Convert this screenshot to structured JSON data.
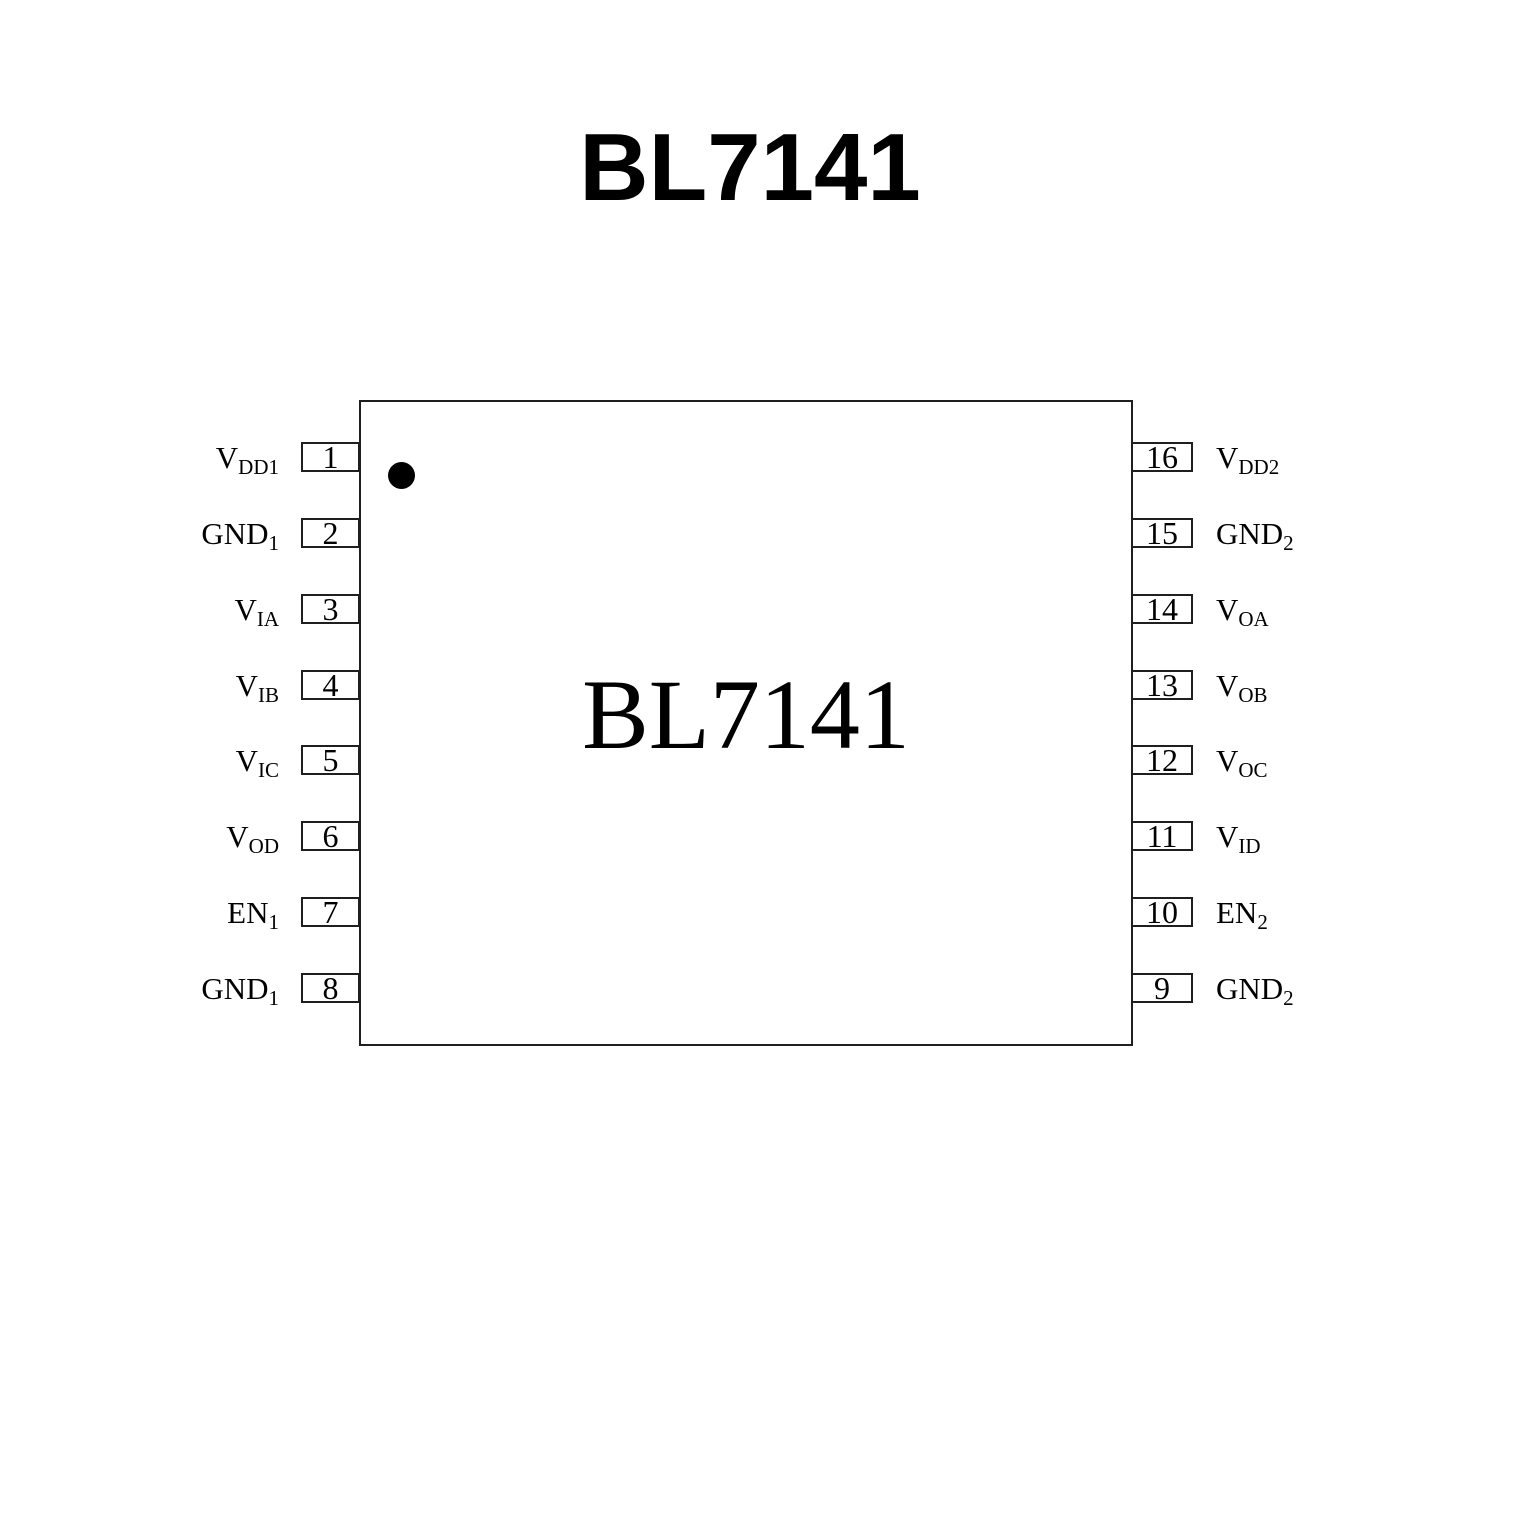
{
  "title": "BL7141",
  "chip": {
    "label": "BL7141",
    "marker": "pin1-indicator-dot"
  },
  "pins": {
    "left": [
      {
        "num": "1",
        "base": "V",
        "sub": "DD1"
      },
      {
        "num": "2",
        "base": "GND",
        "sub": "1"
      },
      {
        "num": "3",
        "base": "V",
        "sub": "IA"
      },
      {
        "num": "4",
        "base": "V",
        "sub": "IB"
      },
      {
        "num": "5",
        "base": "V",
        "sub": "IC"
      },
      {
        "num": "6",
        "base": "V",
        "sub": "OD"
      },
      {
        "num": "7",
        "base": "EN",
        "sub": "1"
      },
      {
        "num": "8",
        "base": "GND",
        "sub": "1"
      }
    ],
    "right": [
      {
        "num": "16",
        "base": "V",
        "sub": "DD2"
      },
      {
        "num": "15",
        "base": "GND",
        "sub": "2"
      },
      {
        "num": "14",
        "base": "V",
        "sub": "OA"
      },
      {
        "num": "13",
        "base": "V",
        "sub": "OB"
      },
      {
        "num": "12",
        "base": "V",
        "sub": "OC"
      },
      {
        "num": "11",
        "base": "V",
        "sub": "ID"
      },
      {
        "num": "10",
        "base": "EN",
        "sub": "2"
      },
      {
        "num": "9",
        "base": "GND",
        "sub": "2"
      }
    ]
  },
  "colors": {
    "ink": "#000000",
    "line": "#1f1f1f",
    "background": "#ffffff"
  }
}
